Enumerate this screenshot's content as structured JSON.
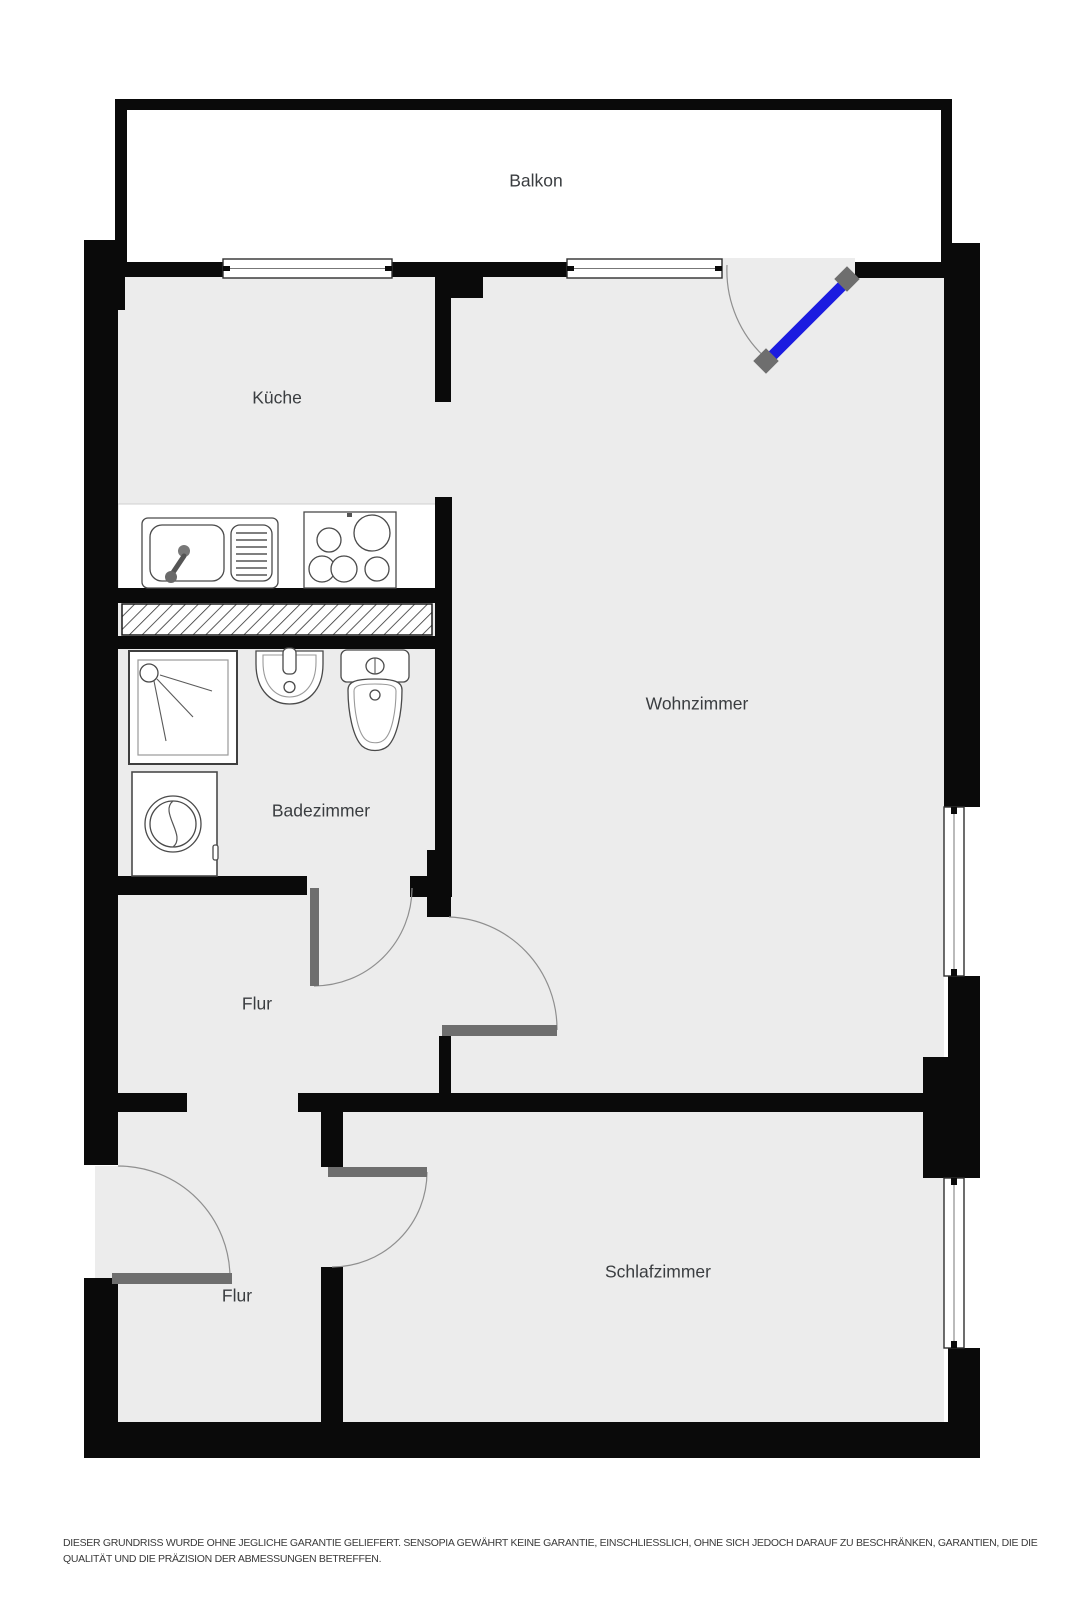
{
  "plan": {
    "title": "Grundriss",
    "rooms": {
      "balkon": "Balkon",
      "kueche": "Küche",
      "wohnzimmer": "Wohnzimmer",
      "badezimmer": "Badezimmer",
      "flur_oben": "Flur",
      "flur_unten": "Flur",
      "schlafzimmer": "Schlafzimmer"
    },
    "fixtures": {
      "sink": "kitchen-sink",
      "cooktop": "cooktop-4-burners",
      "shower": "shower",
      "washbasin": "washbasin",
      "toilet": "toilet",
      "washing_machine": "washing-machine"
    },
    "colors": {
      "wall": "#0a0a0a",
      "floor": "#ececec",
      "door_leaf": "#6e6e6e",
      "balcony_door_leaf": "#1c1ce0",
      "swing_arc": "#8f8f8f"
    },
    "disclaimer": {
      "line1": "DIESER GRUNDRISS WURDE OHNE JEGLICHE GARANTIE GELIEFERT. SENSOPIA GEWÄHRT KEINE GARANTIE, EINSCHLIESSLICH, OHNE SICH JEDOCH DARAUF ZU BESCHRÄNKEN, GARANTIEN, DIE DIE",
      "line2": "QUALITÄT UND DIE PRÄZISION DER ABMESSUNGEN BETREFFEN."
    }
  }
}
